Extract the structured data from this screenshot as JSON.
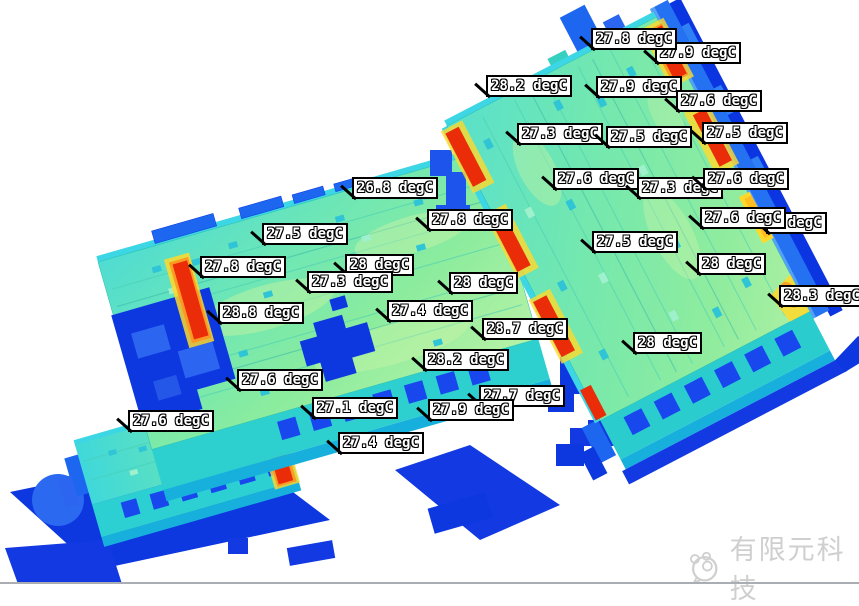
{
  "scene": {
    "type": "thermal-simulation-3d-view",
    "description": "Temperature contour plot of two stacked PCB assemblies with probe labels",
    "units": "degC",
    "colors": {
      "hot_red": "#ea2c08",
      "warm_orange": "#ff9420",
      "warning_yellow": "#ffd92a",
      "surface_green": "#8cec9d",
      "surface_cyan": "#4fdcd2",
      "cold_blue": "#0d38e0",
      "edge_blue": "#2471f2",
      "connector_blue": "#1847ee"
    }
  },
  "labels": [
    {
      "text": "27.9 degC",
      "x": 655,
      "y": 42
    },
    {
      "text": "27.8 degC",
      "x": 591,
      "y": 28
    },
    {
      "text": "28.2 degC",
      "x": 486,
      "y": 75
    },
    {
      "text": "27.9 degC",
      "x": 596,
      "y": 76
    },
    {
      "text": "27.6 degC",
      "x": 676,
      "y": 90
    },
    {
      "text": "27.3 degC",
      "x": 517,
      "y": 123
    },
    {
      "text": "27.5 degC",
      "x": 606,
      "y": 126
    },
    {
      "text": "27.5 degC",
      "x": 702,
      "y": 122
    },
    {
      "text": "27.6 degC",
      "x": 553,
      "y": 168
    },
    {
      "text": "27.3 degC",
      "x": 637,
      "y": 177
    },
    {
      "text": "27.6 degC",
      "x": 703,
      "y": 168
    },
    {
      "text": "8 degC",
      "x": 766,
      "y": 212
    },
    {
      "text": "27.6 degC",
      "x": 700,
      "y": 207
    },
    {
      "text": "27.5 degC",
      "x": 592,
      "y": 231
    },
    {
      "text": "28 degC",
      "x": 697,
      "y": 253
    },
    {
      "text": "28.3 degC",
      "x": 779,
      "y": 285
    },
    {
      "text": "28 degC",
      "x": 633,
      "y": 332
    },
    {
      "text": "26.8 degC",
      "x": 352,
      "y": 177
    },
    {
      "text": "27.8 degC",
      "x": 427,
      "y": 209
    },
    {
      "text": "27.5 degC",
      "x": 262,
      "y": 223
    },
    {
      "text": "27.8 degC",
      "x": 200,
      "y": 256
    },
    {
      "text": "28 degC",
      "x": 345,
      "y": 254
    },
    {
      "text": "27.3 degC",
      "x": 307,
      "y": 271
    },
    {
      "text": "28 degC",
      "x": 449,
      "y": 272
    },
    {
      "text": "28.8 degC",
      "x": 218,
      "y": 302
    },
    {
      "text": "27.4 degC",
      "x": 387,
      "y": 300
    },
    {
      "text": "28.7 degC",
      "x": 482,
      "y": 318
    },
    {
      "text": "28.2 degC",
      "x": 423,
      "y": 349
    },
    {
      "text": "27.6 degC",
      "x": 237,
      "y": 369
    },
    {
      "text": "27.7 degC",
      "x": 479,
      "y": 385
    },
    {
      "text": "27.1 degC",
      "x": 312,
      "y": 397
    },
    {
      "text": "27.9 degC",
      "x": 428,
      "y": 399
    },
    {
      "text": "27.6 degC",
      "x": 128,
      "y": 410
    },
    {
      "text": "27.4 degC",
      "x": 338,
      "y": 432
    }
  ],
  "watermark": {
    "text": "有限元科技"
  }
}
